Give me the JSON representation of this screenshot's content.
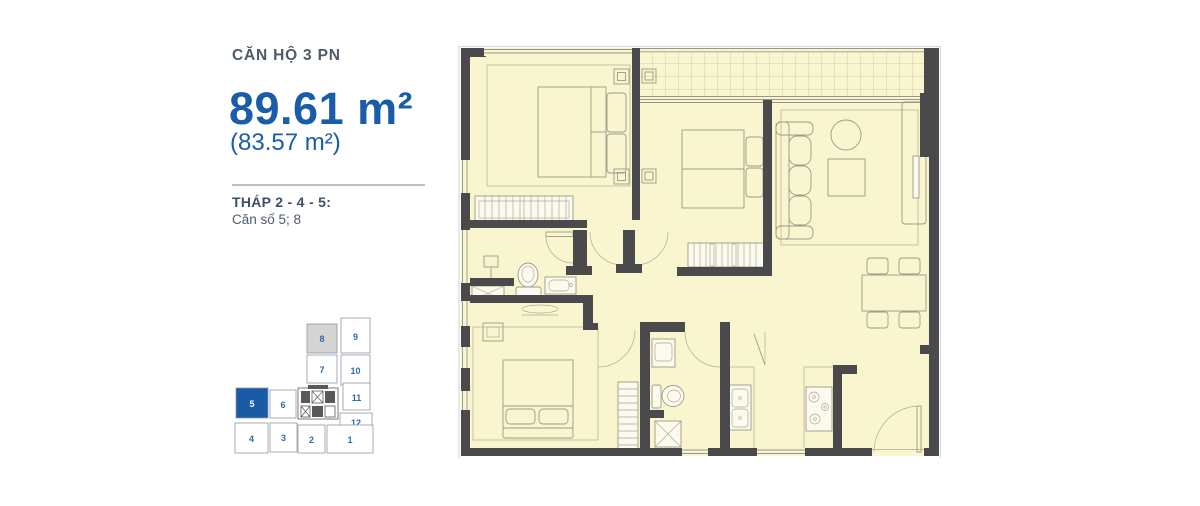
{
  "panel": {
    "title": "CĂN HỘ 3 PN",
    "area_main": "89.61 m²",
    "area_secondary": "(83.57 m²)",
    "tower_label": "THÁP 2 - 4 - 5:",
    "unit_label": "Căn số 5; 8",
    "accent_color": "#1a5ca8",
    "heading_color": "#4e5a6a"
  },
  "keyplan": {
    "border_color": "#8f98a3",
    "number_color": "#2d6cab",
    "highlight_fill": "#1a5ba6",
    "muted_fill": "#d4d4d4",
    "units": [
      {
        "label": "8",
        "fill": "#d4d4d4",
        "text": "#2d6cab"
      },
      {
        "label": "9",
        "fill": "#ffffff",
        "text": "#2d6cab"
      },
      {
        "label": "7",
        "fill": "#ffffff",
        "text": "#2d6cab"
      },
      {
        "label": "10",
        "fill": "#ffffff",
        "text": "#2d6cab"
      },
      {
        "label": "5",
        "fill": "#1a5ba6",
        "text": "#ffffff"
      },
      {
        "label": "6",
        "fill": "#ffffff",
        "text": "#2d6cab"
      },
      {
        "label": "11",
        "fill": "#ffffff",
        "text": "#2d6cab"
      },
      {
        "label": "12",
        "fill": "#ffffff",
        "text": "#2d6cab"
      },
      {
        "label": "4",
        "fill": "#ffffff",
        "text": "#2d6cab"
      },
      {
        "label": "3",
        "fill": "#ffffff",
        "text": "#2d6cab"
      },
      {
        "label": "2",
        "fill": "#ffffff",
        "text": "#2d6cab"
      },
      {
        "label": "1",
        "fill": "#ffffff",
        "text": "#2d6cab"
      }
    ]
  },
  "floorplan": {
    "room_fill": "#f9f5cf",
    "wall_color": "#4a4a4c",
    "furniture_line_color": "#9c9c86",
    "balcony_grid_color": "#c4c1a2"
  }
}
